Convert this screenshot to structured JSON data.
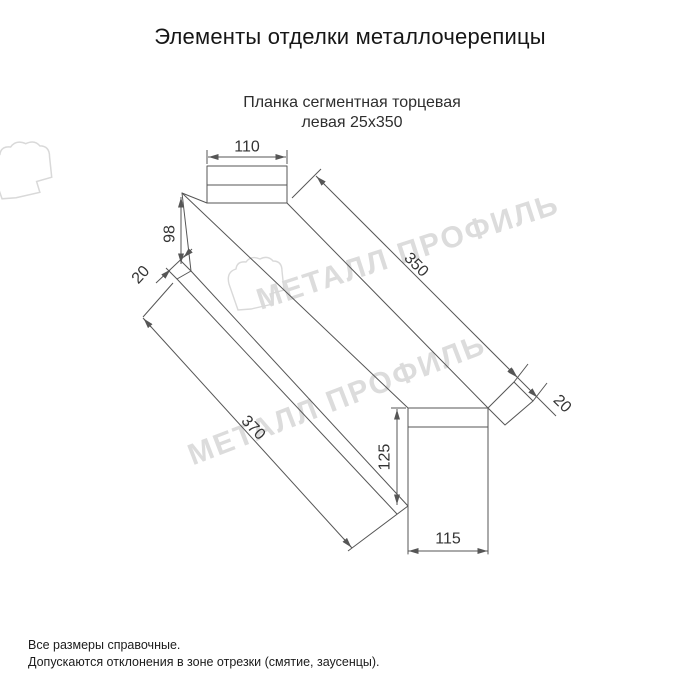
{
  "header": {
    "title": "Элементы отделки металлочерепицы"
  },
  "product": {
    "name_line1": "Планка сегментная торцевая",
    "name_line2": "левая 25х350"
  },
  "drawing": {
    "type": "isometric technical drawing of left segmented end trim strip",
    "dims": {
      "top_width": "110",
      "wall_height": "98",
      "left_fold": "20",
      "top_length": "350",
      "right_fold": "20",
      "bottom_length": "370",
      "end_height": "125",
      "end_width": "115"
    },
    "line_color": "#565656",
    "dim_text_color": "#333333"
  },
  "watermark": {
    "text": "МЕТАЛЛ ПРОФИЛЬ",
    "color": "#dcdcdc"
  },
  "footer": {
    "note1": "Все размеры справочные.",
    "note2": "Допускаются отклонения в зоне отрезки (смятие, заусенцы)."
  }
}
